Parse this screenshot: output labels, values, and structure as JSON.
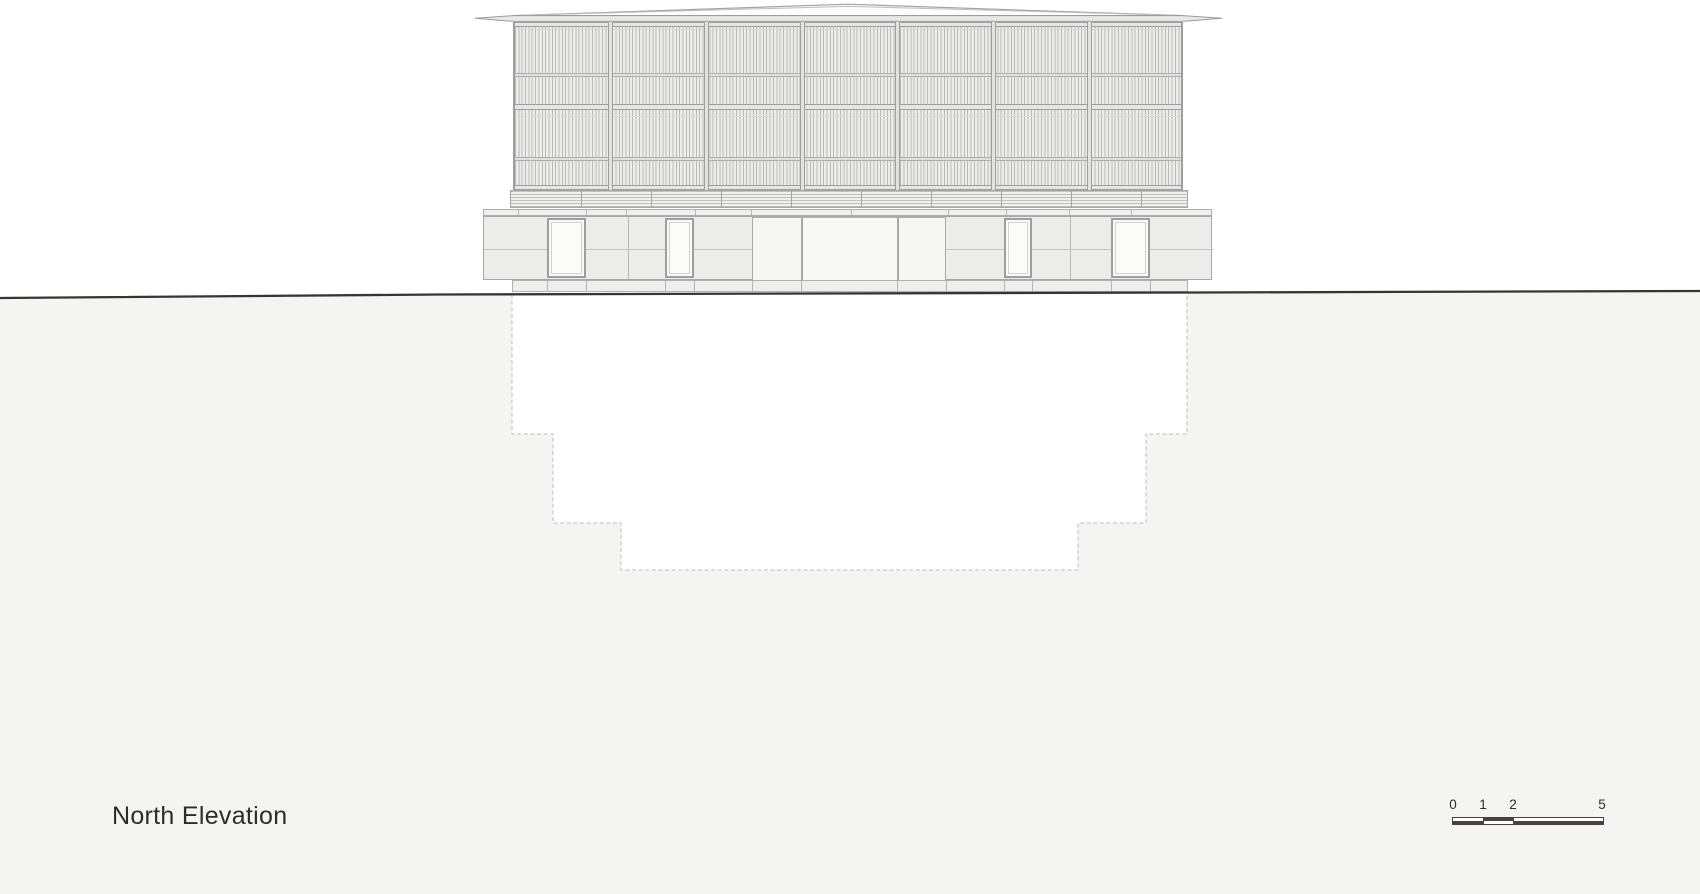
{
  "document": {
    "type": "architectural-drawing",
    "view": "elevation"
  },
  "title": {
    "label": "North Elevation"
  },
  "scale_bar": {
    "labels": [
      "0",
      "1",
      "2",
      "5"
    ]
  },
  "building": {
    "louver_bays": 7,
    "stories_above_ground": 2,
    "basement_step_tiers": 3,
    "door_count": 4,
    "entrance_bays": 3
  },
  "palette": {
    "background": "#ffffff",
    "below_grade_fill": "#f4f4f2",
    "ground_line": "#3a3430",
    "linework": "#a0a0a0",
    "panel_fill": "#ececeb",
    "excavation_dash": "#bdbdbd",
    "scale_bar_dark": "#4a423e",
    "text": "#2e2c2a"
  }
}
